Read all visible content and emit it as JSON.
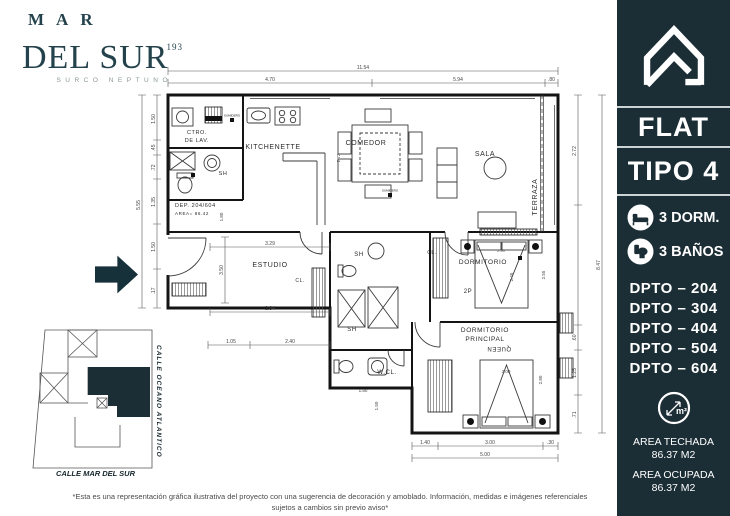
{
  "brand": {
    "line1": "MAR",
    "line2": "DEL SUR",
    "number": "193",
    "subtitle": "SURCO NEPTUNO"
  },
  "sidebar": {
    "bg_color": "#1b2d35",
    "title_line1": "FLAT",
    "title_line2": "TIPO 4",
    "features": [
      {
        "icon": "bed-icon",
        "label": "3 DORM."
      },
      {
        "icon": "toilet-icon",
        "label": "3 BAÑOS"
      }
    ],
    "units": [
      "DPTO – 204",
      "DPTO – 304",
      "DPTO – 404",
      "DPTO – 504",
      "DPTO – 604"
    ],
    "area_unit_symbol": "m²",
    "areas": [
      {
        "label": "AREA TECHADA",
        "value": "86.37 M2"
      },
      {
        "label": "AREA OCUPADA",
        "value": "86.37 M2"
      }
    ]
  },
  "plan": {
    "rooms": {
      "lavanderia_l1": "CTRO.",
      "lavanderia_l2": "DE LAV.",
      "kitchenette": "KITCHENETTE",
      "comedor": "COMEDOR",
      "sala": "SALA",
      "terraza": "TERRAZA",
      "estudio": "ESTUDIO",
      "sh": "SH",
      "closet": "CL.",
      "walkin": "W.CL.",
      "dormitorio": "DORMITORIO",
      "dormitorio_beds": "2P",
      "principal_l1": "DORMITORIO",
      "principal_l2": "PRINCIPAL",
      "principal_bed": "QUEEN"
    },
    "unit_note": {
      "line1": "DEP. 204/604",
      "line2": "AREA= 86.42"
    },
    "fixture_marker": "SUMIDERO",
    "dims": {
      "top_total": "11.54",
      "top1": "4.70",
      "top2": "5.94",
      "top3": ".80",
      "left_total": "5.55",
      "left1": "1.50",
      "left2": ".45",
      "left3": ".72",
      "left4": "1.35",
      "left5": "1.50",
      "left6": ".17",
      "right_total": "8.47",
      "right1": "2.72",
      "right2": ".60",
      "right3": "1.25",
      "right4": ".71",
      "bottom1": "1.40",
      "bottom2": "3.00",
      "bottom3": ".30",
      "bottom_total": "5.00",
      "estudio_w": "3.29",
      "estudio_h": "3.50",
      "estudio_w2": "2.84",
      "hall1": "1.05",
      "hall2": "2.40",
      "entry_h": "1.80",
      "comedor_h": "2.72",
      "dorm_bed_w": "2.90",
      "dorm_d": "2.45",
      "dorm_h": "2.55",
      "princ_w": "3.00",
      "princ_h": "2.80",
      "wc_w": "1.80",
      "wc_h": "1.50"
    }
  },
  "minimap": {
    "street_right": "CALLE OCEANO ATLANTICO",
    "street_bottom": "CALLE MAR DEL SUR",
    "unit_color": "#1b2d35"
  },
  "disclaimer": "*Esta es una representación gráfica ilustrativa del proyecto con una sugerencia de decoración y amoblado. Información, medidas e imágenes referenciales sujetos a cambios sin previo aviso*"
}
